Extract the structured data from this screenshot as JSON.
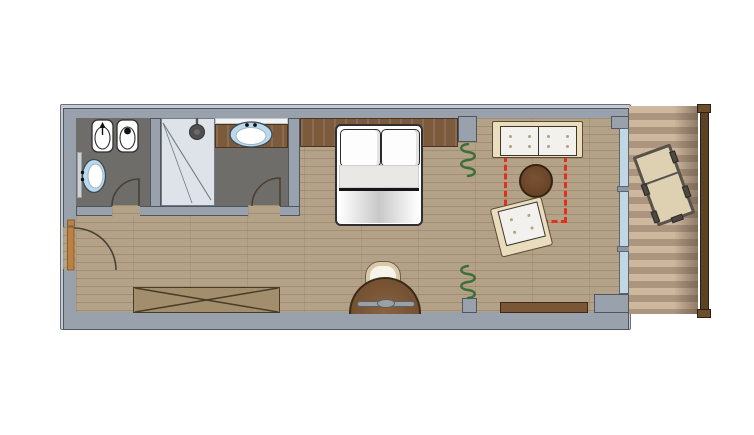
{
  "scene": {
    "type": "hotel-room floor plan, top view, no text labels",
    "rooms": [
      "entrance hall",
      "wc",
      "shower bathroom",
      "sleeping area",
      "living area",
      "balcony"
    ],
    "fixtures_and_furniture": [
      "bidet",
      "toilet",
      "wall washbasin",
      "wc mirror",
      "shower cabin with shower head",
      "vanity counter with oval washbasin",
      "interior doors with swing arcs",
      "entrance door with swing arc",
      "double bed with two pillows and duvet",
      "headboard wall panel",
      "curtain symbols (green coils)",
      "wardrobe with crossed diagonals",
      "semicircular desk with chair",
      "low sideboard bench",
      "two-seat sofa with tufted cushions",
      "round coffee table",
      "tufted armchair (rotated)",
      "red dashed rug outline",
      "glass facade with mullions",
      "striped wooden balcony deck",
      "balcony railing with posts",
      "sun lounger (rotated)"
    ]
  },
  "colors": {
    "wall": "#99a2ac",
    "wallEdge": "#4e5660",
    "wallLight": "#c6cad1",
    "wood": "#b3a287",
    "bathFloor": "#6f6d6a",
    "shower": "#dde3e8",
    "showerEdge": "#737b83",
    "glass": "#c2d6e6",
    "glassEdge": "#5a6570",
    "basinBlue": "#bcd9ec",
    "fixtureEdge": "#2e2e2e",
    "headboard": "#7c5b3d",
    "woodDark": "#7a5636",
    "woodDarkEdge": "#3a2a18",
    "sofaFrame": "#eaddbd",
    "cushion": "#f2f1ee",
    "dotColor": "#b3a37d",
    "accentRed": "#e0301e",
    "curtainGreen": "#3f6d39",
    "wardrobe": "#a28d6d",
    "wardrobeEdge": "#473c28",
    "deckLight": "#cdb79d",
    "deckDark": "#ab957f",
    "railing": "#5c4326",
    "railingEdge": "#2e2012",
    "loungeFrame": "#57534c",
    "loungeSeat": "#ded1b2",
    "doorArc": "#4a3f35",
    "doorLeaf": "#bc8140",
    "mirror": "#cdd2d6"
  }
}
